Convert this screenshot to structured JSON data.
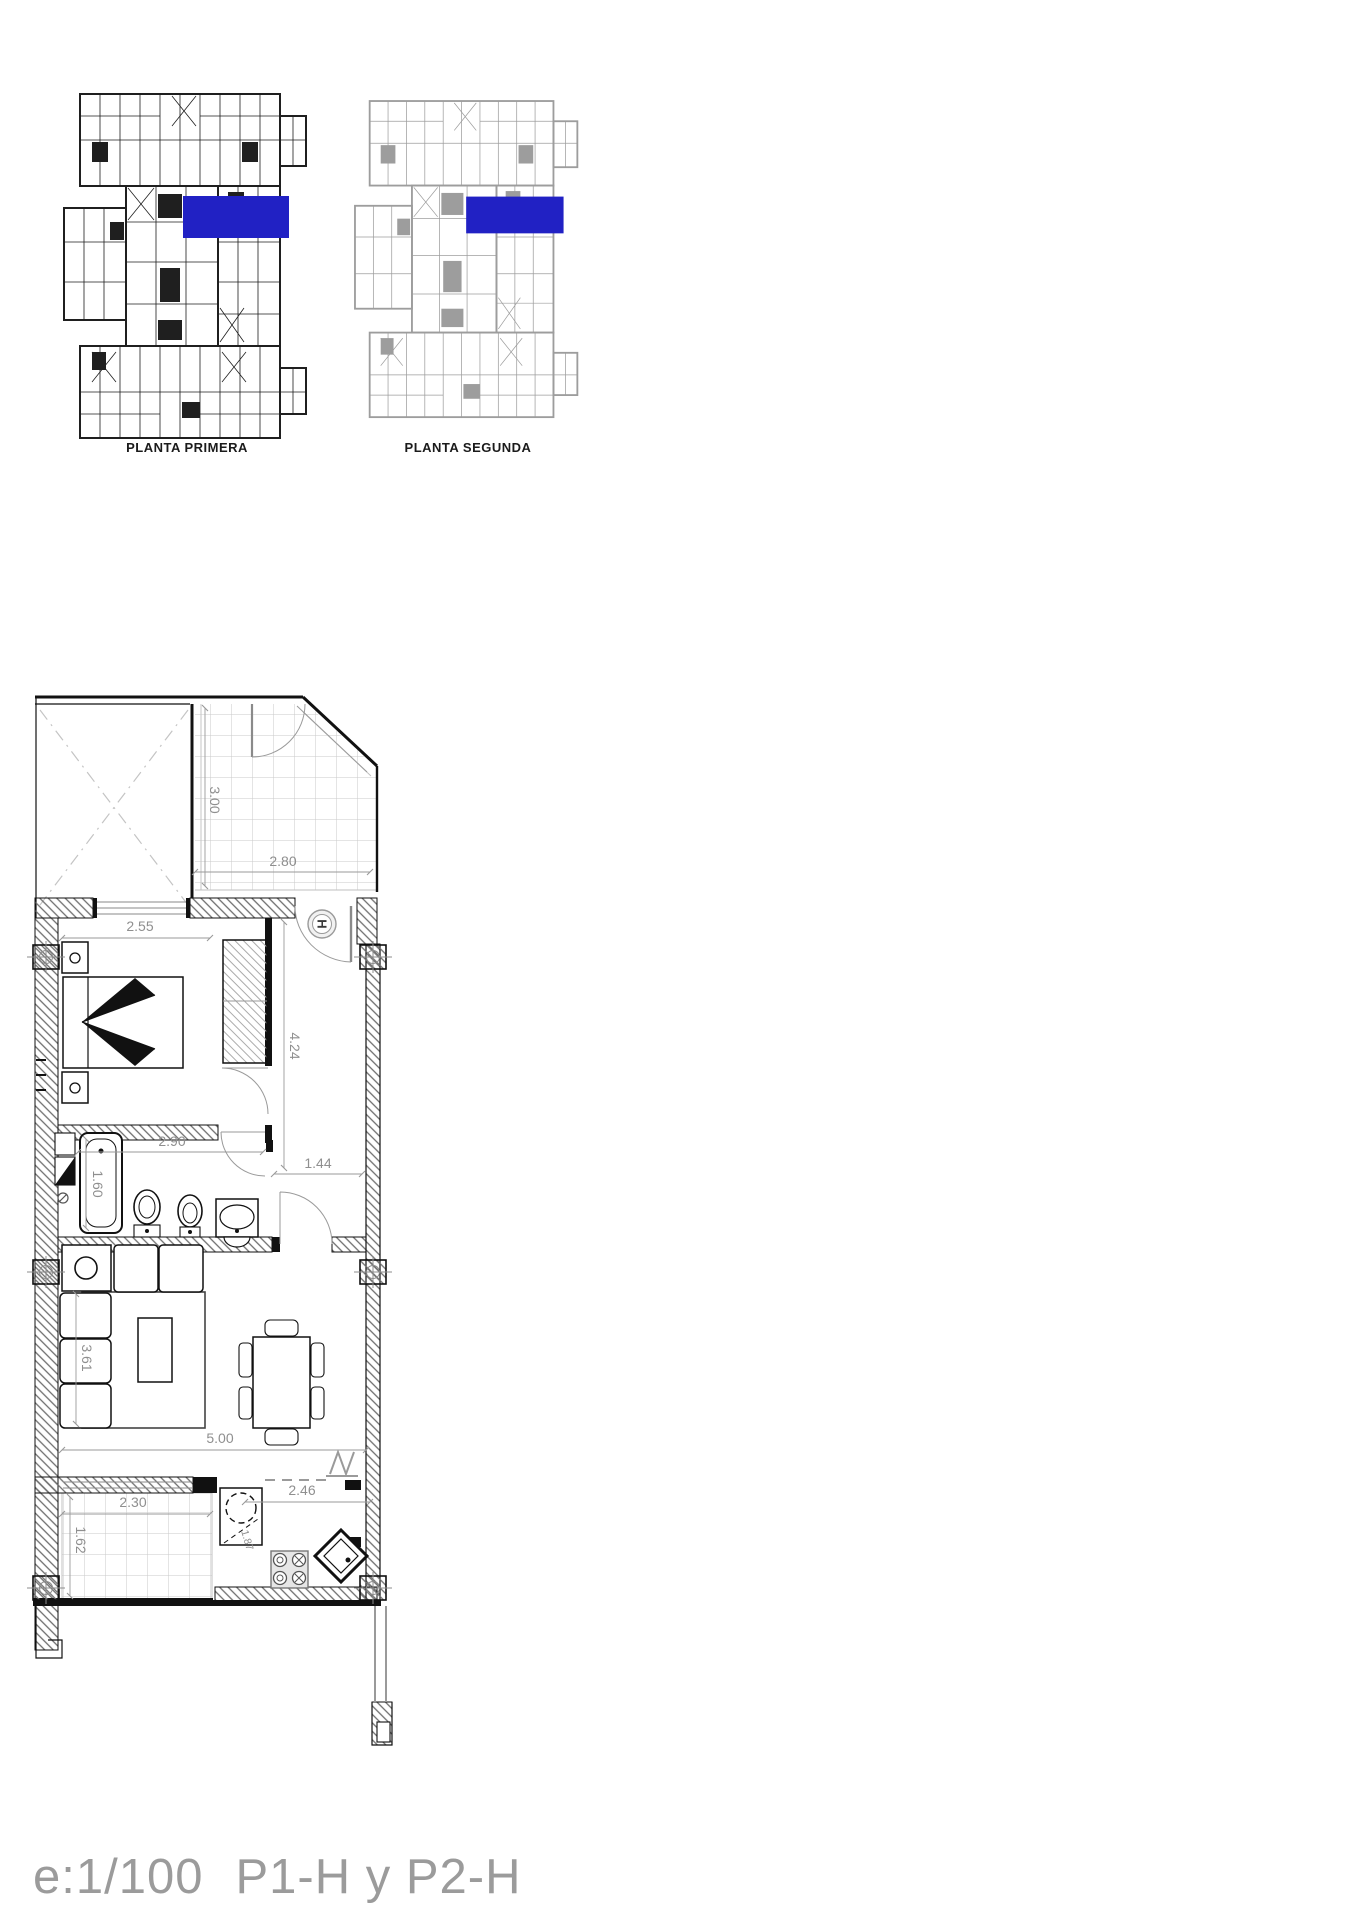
{
  "colors": {
    "highlight": "#2121c4",
    "walls": "#111111",
    "dim_text": "#8f8f8f",
    "footer_text": "#9b9b9b"
  },
  "overview": {
    "plans": [
      {
        "label": "PLANTA PRIMERA"
      },
      {
        "label": "PLANTA SEGUNDA"
      }
    ]
  },
  "floorplan": {
    "hall_mark": "H",
    "dims": {
      "terrace_depth": "3.00",
      "terrace_width": "2.80",
      "bedroom_width": "2.55",
      "corridor_length": "4.24",
      "bathroom_width": "2.90",
      "hall_width": "1.44",
      "bathtub_length": "1.60",
      "living_depth": "3.61",
      "living_width": "5.00",
      "terrace2_width": "2.30",
      "terrace2_depth": "1.62",
      "kitchen_width": "2.46",
      "kitchen_diagonal": "1.87"
    }
  },
  "footer": {
    "scale": "e:1/100",
    "plan_codes": "P1-H y P2-H"
  }
}
